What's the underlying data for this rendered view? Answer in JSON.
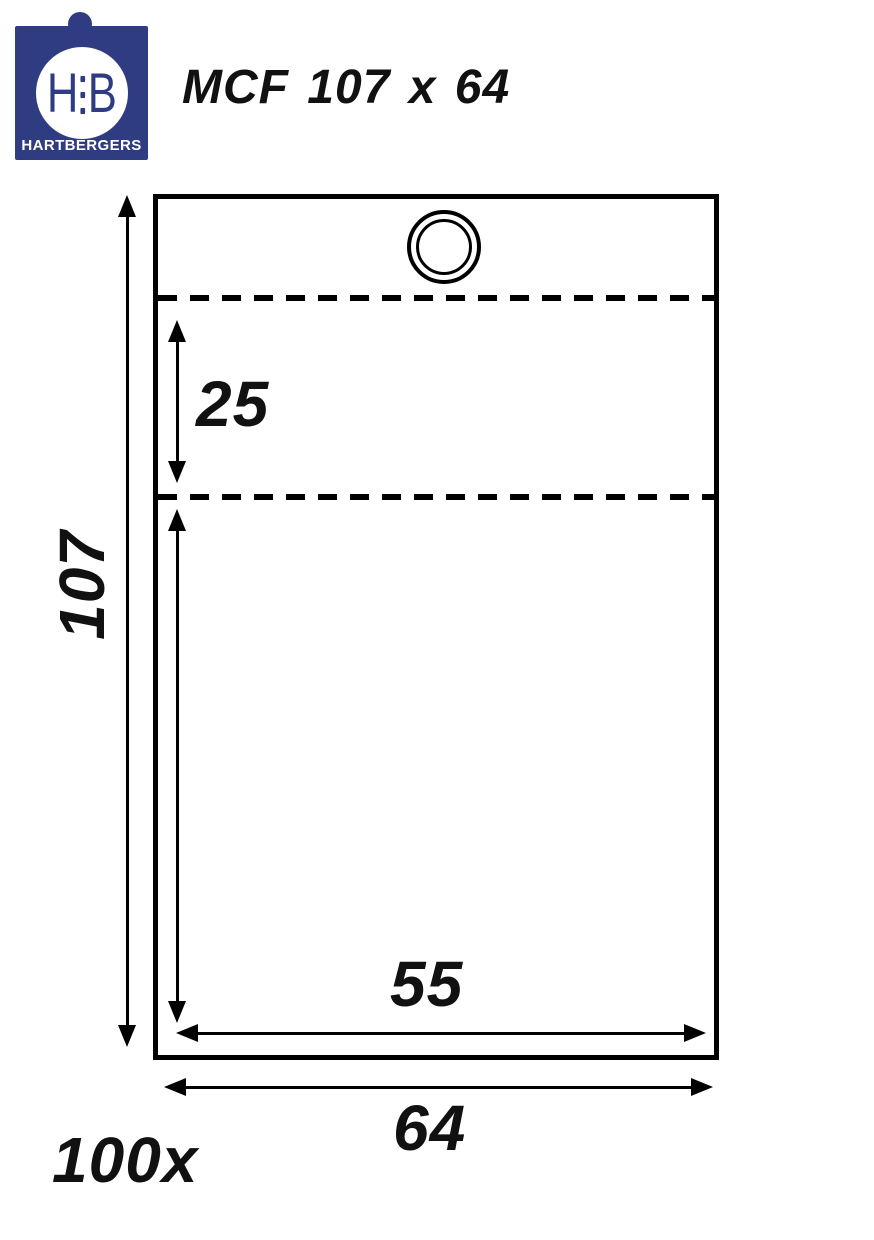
{
  "logo": {
    "monogram_left": "H",
    "monogram_right": "B",
    "brand": "HARTBERGERS",
    "blue": "#303c82"
  },
  "header": {
    "title": "MCF 107 x 64"
  },
  "diagram": {
    "labels": {
      "total_height": "107",
      "flap_height": "25",
      "inner_width": "55",
      "total_width": "64"
    },
    "quantity": "100x",
    "line_color": "#000000"
  }
}
